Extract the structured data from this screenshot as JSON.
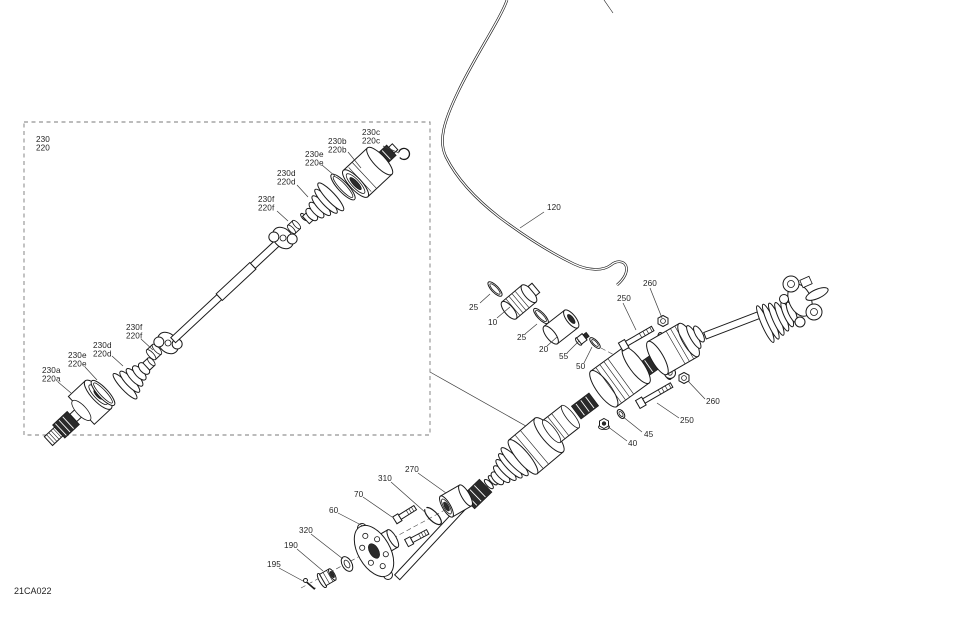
{
  "diagram": {
    "code": "21CA022",
    "background": "#ffffff",
    "line_color": "#1a1a1a",
    "label_color": "#1f1f1f",
    "label_font_px": 8.2,
    "detail_box": {
      "x": 24,
      "y": 122,
      "width": 406,
      "height": 313
    },
    "detail_box_pointer": [
      430,
      372,
      540,
      434
    ]
  },
  "labels": [
    {
      "id": "label-230-220",
      "lines": [
        "230",
        "220"
      ],
      "x": 36,
      "y": 142,
      "leader": null
    },
    {
      "id": "label-230c-220c",
      "lines": [
        "230c",
        "220c"
      ],
      "x": 362,
      "y": 135,
      "leader": [
        383,
        146,
        399,
        153
      ]
    },
    {
      "id": "label-230b-220b",
      "lines": [
        "230b",
        "220b"
      ],
      "x": 328,
      "y": 144,
      "leader": [
        348,
        152,
        361,
        168
      ]
    },
    {
      "id": "label-230e-220e-top",
      "lines": [
        "230e",
        "220e"
      ],
      "x": 305,
      "y": 157,
      "leader": [
        322,
        165,
        335,
        176
      ]
    },
    {
      "id": "label-230d-220d-top",
      "lines": [
        "230d",
        "220d"
      ],
      "x": 277,
      "y": 176,
      "leader": [
        297,
        185,
        308,
        197
      ]
    },
    {
      "id": "label-230f-220f-top",
      "lines": [
        "230f",
        "220f"
      ],
      "x": 258,
      "y": 202,
      "leader": [
        277,
        211,
        288,
        221
      ]
    },
    {
      "id": "label-230f-220f-low",
      "lines": [
        "230f",
        "220f"
      ],
      "x": 126,
      "y": 330,
      "leader": [
        141,
        339,
        153,
        350
      ]
    },
    {
      "id": "label-230d-220d-low",
      "lines": [
        "230d",
        "220d"
      ],
      "x": 93,
      "y": 348,
      "leader": [
        112,
        356,
        123,
        366
      ]
    },
    {
      "id": "label-230e-220e-low",
      "lines": [
        "230e",
        "220e"
      ],
      "x": 68,
      "y": 358,
      "leader": [
        85,
        367,
        97,
        380
      ]
    },
    {
      "id": "label-230a-220a",
      "lines": [
        "230a",
        "220a"
      ],
      "x": 42,
      "y": 373,
      "leader": [
        58,
        382,
        71,
        393
      ]
    },
    {
      "id": "label-120",
      "lines": [
        "120"
      ],
      "x": 547,
      "y": 210,
      "leader": [
        544,
        212,
        520,
        228
      ]
    },
    {
      "id": "label-25-1",
      "lines": [
        "25"
      ],
      "x": 469,
      "y": 310,
      "leader": [
        480,
        303,
        490,
        294
      ]
    },
    {
      "id": "label-10",
      "lines": [
        "10"
      ],
      "x": 488,
      "y": 325,
      "leader": [
        497,
        318,
        510,
        307
      ]
    },
    {
      "id": "label-25-2",
      "lines": [
        "25"
      ],
      "x": 517,
      "y": 340,
      "leader": [
        525,
        334,
        537,
        324
      ]
    },
    {
      "id": "label-20",
      "lines": [
        "20"
      ],
      "x": 539,
      "y": 352,
      "leader": [
        547,
        346,
        557,
        337
      ]
    },
    {
      "id": "label-55",
      "lines": [
        "55"
      ],
      "x": 559,
      "y": 359,
      "leader": [
        567,
        353,
        579,
        341
      ]
    },
    {
      "id": "label-50",
      "lines": [
        "50"
      ],
      "x": 576,
      "y": 369,
      "leader": [
        584,
        363,
        592,
        347
      ]
    },
    {
      "id": "label-250-top",
      "lines": [
        "250"
      ],
      "x": 617,
      "y": 301,
      "leader": [
        623,
        303,
        636,
        330
      ]
    },
    {
      "id": "label-260-top",
      "lines": [
        "260"
      ],
      "x": 643,
      "y": 286,
      "leader": [
        650,
        288,
        662,
        318
      ]
    },
    {
      "id": "label-260-low",
      "lines": [
        "260"
      ],
      "x": 706,
      "y": 404,
      "leader": [
        705,
        399,
        688,
        381
      ]
    },
    {
      "id": "label-250-low",
      "lines": [
        "250"
      ],
      "x": 680,
      "y": 423,
      "leader": [
        679,
        418,
        657,
        403
      ]
    },
    {
      "id": "label-45",
      "lines": [
        "45"
      ],
      "x": 644,
      "y": 437,
      "leader": [
        642,
        432,
        622,
        416
      ]
    },
    {
      "id": "label-40",
      "lines": [
        "40"
      ],
      "x": 628,
      "y": 446,
      "leader": [
        627,
        441,
        607,
        426
      ]
    },
    {
      "id": "label-270",
      "lines": [
        "270"
      ],
      "x": 405,
      "y": 472,
      "leader": [
        418,
        473,
        446,
        493
      ]
    },
    {
      "id": "label-310",
      "lines": [
        "310"
      ],
      "x": 378,
      "y": 481,
      "leader": [
        391,
        482,
        426,
        513
      ]
    },
    {
      "id": "label-70",
      "lines": [
        "70"
      ],
      "x": 354,
      "y": 497,
      "leader": [
        363,
        497,
        392,
        517
      ]
    },
    {
      "id": "label-60",
      "lines": [
        "60"
      ],
      "x": 329,
      "y": 513,
      "leader": [
        338,
        513,
        363,
        526
      ]
    },
    {
      "id": "label-320",
      "lines": [
        "320"
      ],
      "x": 299,
      "y": 533,
      "leader": [
        311,
        534,
        343,
        559
      ]
    },
    {
      "id": "label-190",
      "lines": [
        "190"
      ],
      "x": 284,
      "y": 548,
      "leader": [
        297,
        549,
        323,
        571
      ]
    },
    {
      "id": "label-195",
      "lines": [
        "195"
      ],
      "x": 267,
      "y": 567,
      "leader": [
        279,
        568,
        303,
        581
      ]
    }
  ]
}
